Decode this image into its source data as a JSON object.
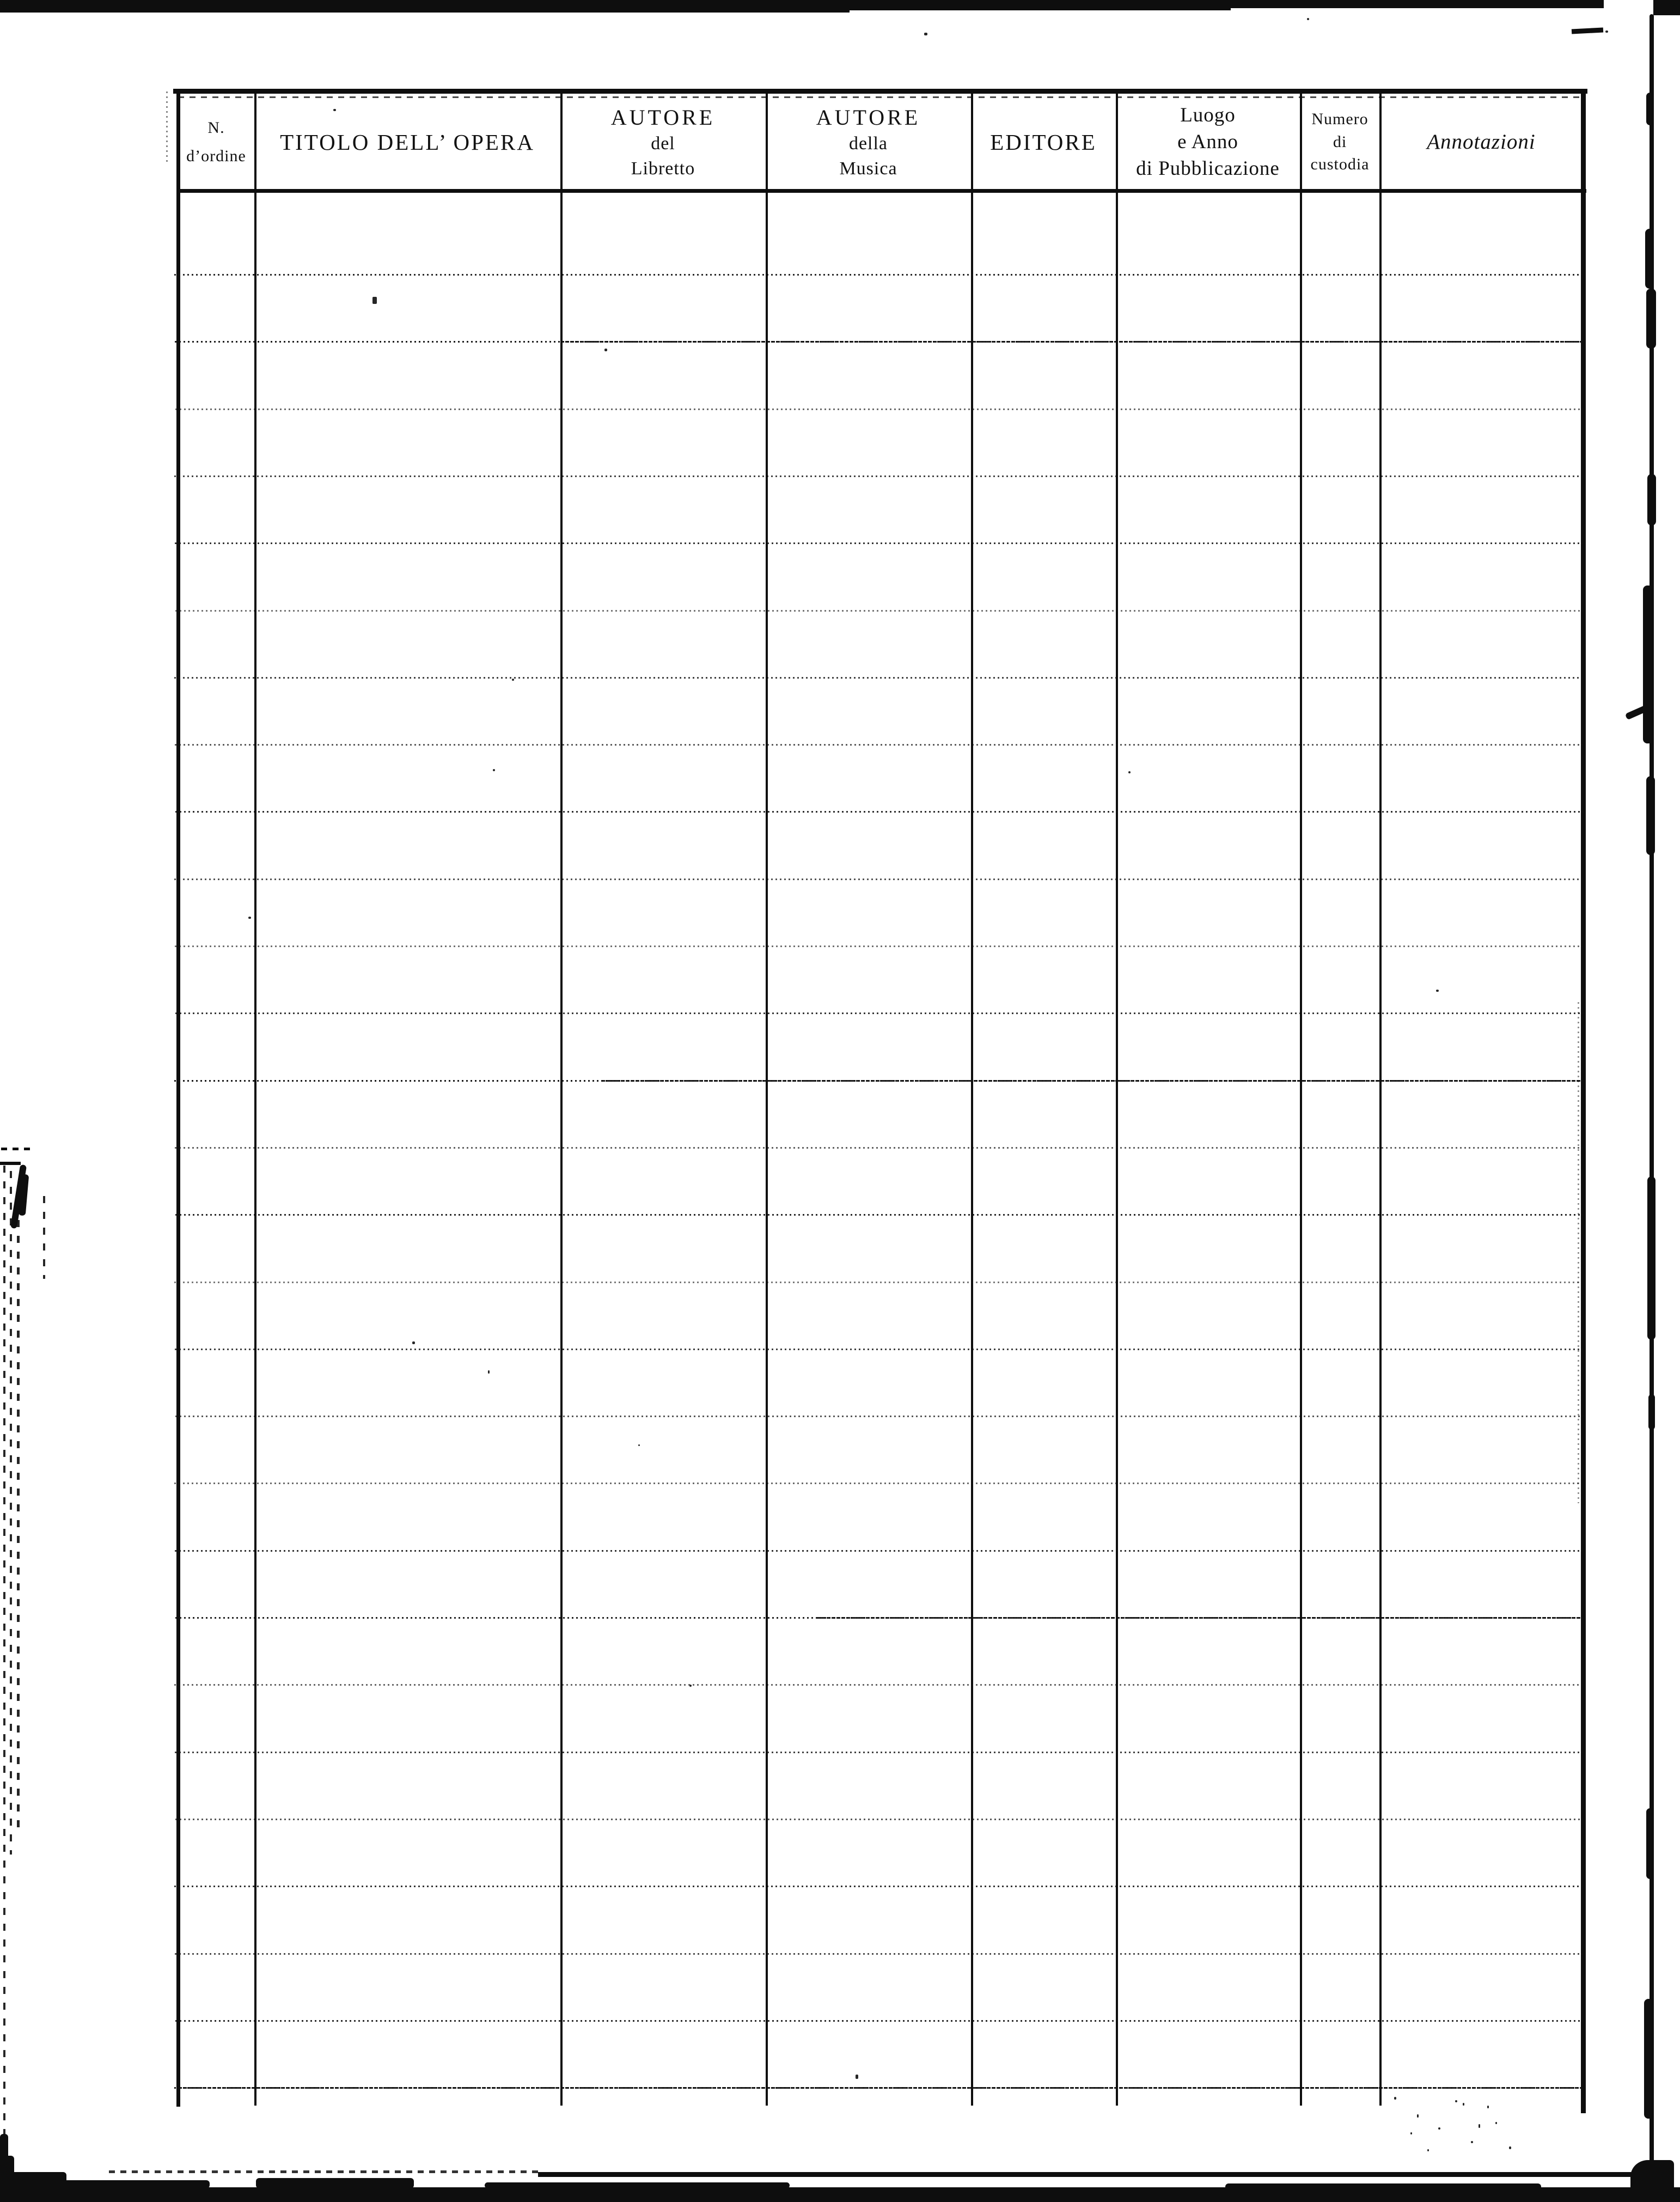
{
  "page": {
    "background": "#ffffff",
    "ink": "#0e0e0e",
    "description_visible_text_only": true
  },
  "table": {
    "columns": [
      {
        "id": "n-ordine",
        "lines": [
          "N.",
          "d’ordine"
        ]
      },
      {
        "id": "titolo-opera",
        "lines": [
          "TITOLO DELL’ OPERA"
        ]
      },
      {
        "id": "autore-libretto",
        "lines": [
          "AUTORE",
          "del",
          "Libretto"
        ]
      },
      {
        "id": "autore-musica",
        "lines": [
          "AUTORE",
          "della",
          "Musica"
        ]
      },
      {
        "id": "editore",
        "lines": [
          "EDITORE"
        ]
      },
      {
        "id": "luogo-anno",
        "lines": [
          "Luogo",
          "e Anno",
          "di Pubblicazione"
        ]
      },
      {
        "id": "numero-custodia",
        "lines": [
          "Numero",
          "di",
          "custodia"
        ]
      },
      {
        "id": "annotazioni",
        "lines": [
          "Annotazioni"
        ]
      }
    ],
    "body_row_lines": 28,
    "entries": []
  }
}
